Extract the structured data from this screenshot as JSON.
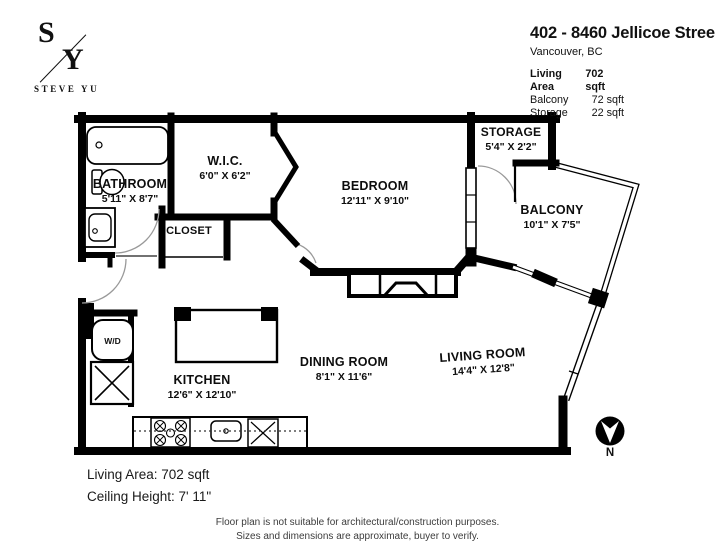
{
  "logo": {
    "top_initial": "S",
    "bottom_initial": "Y",
    "brand": "STEVE YU"
  },
  "header": {
    "title": "402 - 8460 Jellicoe Street",
    "subtitle": "Vancouver, BC",
    "areas": [
      {
        "label": "Living Area",
        "value": "702 sqft"
      },
      {
        "label": "Balcony",
        "value": "72 sqft"
      },
      {
        "label": "Storage",
        "value": "22 sqft"
      }
    ]
  },
  "rooms": {
    "bathroom": {
      "name": "BATHROOM",
      "dims": "5'11\" X 8'7\""
    },
    "wic": {
      "name": "W.I.C.",
      "dims": "6'0\" X 6'2\""
    },
    "closet": {
      "name": "CLOSET"
    },
    "bedroom": {
      "name": "BEDROOM",
      "dims": "12'11\" X 9'10\""
    },
    "storage": {
      "name": "STORAGE",
      "dims": "5'4\" X 2'2\""
    },
    "balcony": {
      "name": "BALCONY",
      "dims": "10'1\" X 7'5\""
    },
    "kitchen": {
      "name": "KITCHEN",
      "dims": "12'6\" X 12'10\""
    },
    "dining": {
      "name": "DINING ROOM",
      "dims": "8'1\" X 11'6\""
    },
    "living": {
      "name": "LIVING ROOM",
      "dims": "14'4\" X 12'8\""
    }
  },
  "labels": {
    "washer_dryer": "W/D"
  },
  "notes": {
    "living_area": "Living Area: 702 sqft",
    "ceiling_height": "Ceiling Height: 7' 11\""
  },
  "disclaimer": {
    "line1": "Floor plan is not suitable for architectural/construction purposes.",
    "line2": "Sizes and dimensions are approximate, buyer to verify."
  },
  "compass": {
    "north": "N"
  },
  "colors": {
    "wall": "#000000",
    "background": "#ffffff",
    "arc": "#999999"
  }
}
